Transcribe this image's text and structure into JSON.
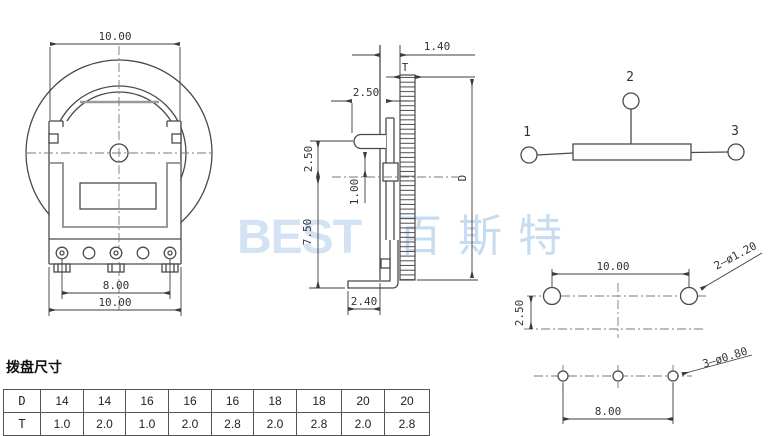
{
  "front_view": {
    "dim_width_top": "10.00",
    "dim_pin_span": "8.00",
    "dim_width_bottom": "10.00"
  },
  "side_view": {
    "dim_bezel": "1.40",
    "label_thickness": "T",
    "dim_lever_offset": "2.50",
    "dim_lever_height": "2.50",
    "dim_center_offset": "1.00",
    "dim_lower_height": "7.50",
    "dim_foot_width": "2.40",
    "label_diameter": "D"
  },
  "schematic": {
    "pin1": "1",
    "pin2": "2",
    "pin3": "3"
  },
  "pcb": {
    "dim_hole_span": "10.00",
    "dim_row_gap": "2.50",
    "label_mount_holes": "2—ø1.20",
    "dim_pin_span": "8.00",
    "label_pin_holes": "3—ø0.80"
  },
  "watermark": {
    "latin": "BEST",
    "cjk": "百斯特"
  },
  "table": {
    "title": "拨盘尺寸",
    "rows": [
      {
        "label": "D",
        "values": [
          "14",
          "14",
          "16",
          "16",
          "16",
          "18",
          "18",
          "20",
          "20"
        ]
      },
      {
        "label": "T",
        "values": [
          "1.0",
          "2.0",
          "1.0",
          "2.0",
          "2.8",
          "2.0",
          "2.8",
          "2.0",
          "2.8"
        ]
      }
    ]
  },
  "colors": {
    "line": "#4a4a4a",
    "gray_line": "#8f8f8f",
    "centerline": "#7a7a7a",
    "watermark_latin": "#d3e3f4",
    "watermark_cjk": "#c8dcf0",
    "background": "#ffffff"
  }
}
